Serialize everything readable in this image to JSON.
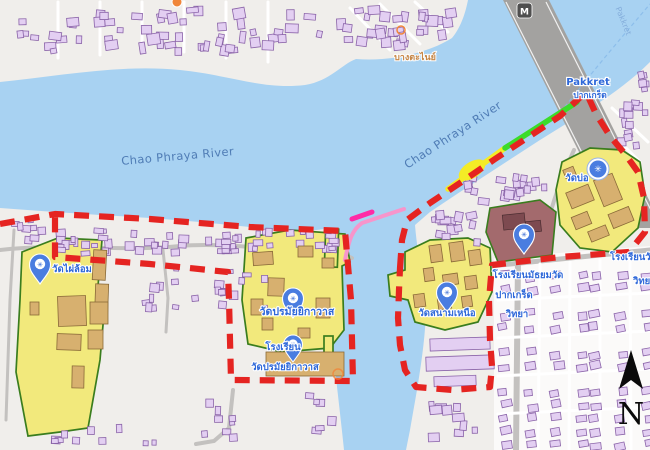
{
  "map": {
    "colors": {
      "water": "#a8d2f2",
      "land": "#f0eeeb",
      "urban": "#fbfaf9",
      "building_fill": "#e3cff2",
      "building_stroke": "#8a63a8",
      "temple_fill": "#f2e97c",
      "temple_stroke": "#3a7d1e",
      "tan_fill": "#d7b06f",
      "tan_stroke": "#8a6a38",
      "maroon_fill": "#a36a6d",
      "boundary_red": "#e52421",
      "route_green": "#3bdc2a",
      "route_yellow": "#f4ec26",
      "route_pink": "#f795cb",
      "route_magenta": "#ff2ba6",
      "road": "#c3c1bf",
      "bridge": "#a3a2a0",
      "pin_blue": "#4a7de0",
      "label_blue": "#2e68d9",
      "river_label": "#4f7cb5",
      "town_orange": "#c8823d"
    },
    "labels": {
      "river_left": "Chao Phraya River",
      "river_right": "Chao Phraya River",
      "pakkret_en": "Pakkret",
      "pakkret_th": "ปากเกร็ด",
      "bang_tanai": "บางตะไนย์",
      "wat_phai_lom": "วัดไผ่ล้อม",
      "wat_poramaiyikawat": "วัดปรมัยยิกาวาส",
      "school_poramai_1": "โรงเรียน",
      "school_poramai_2": "วัดปรมัยยิกาวาส",
      "wat_sanam_nuea": "วัดสนามเหนือ",
      "wat_bo": "วัดบ่อ",
      "school_pakkret_1": "โรงเรียนมัธยมวัด",
      "school_pakkret_2": "ปากเกร็ด",
      "school_pakkret_3": "วิทยา",
      "school_edge_1": "โรงเรียนวัด",
      "school_edge_2": "วิทยา",
      "bridge_label": "Pakkret",
      "bridge_badge": "M",
      "compass": "N"
    }
  }
}
